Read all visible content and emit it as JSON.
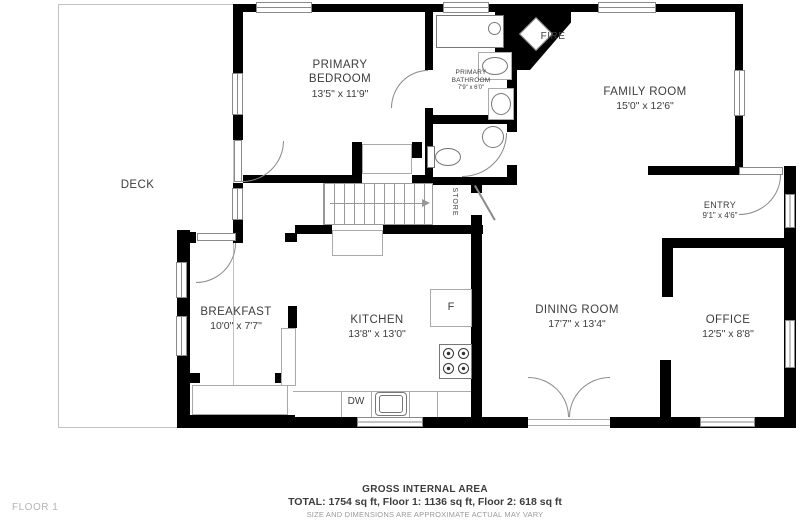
{
  "floor_label": "FLOOR 1",
  "rooms": {
    "deck": {
      "name": "DECK"
    },
    "primary_bedroom": {
      "name": "PRIMARY BEDROOM",
      "dims": "13'5\" x 11'9\""
    },
    "primary_bathroom": {
      "name": "PRIMARY BATHROOM",
      "dims": "7'9\" x 6'0\""
    },
    "family_room": {
      "name": "FAMILY ROOM",
      "dims": "15'0\" x 12'6\""
    },
    "entry": {
      "name": "ENTRY",
      "dims": "9'1\" x 4'6\""
    },
    "breakfast": {
      "name": "BREAKFAST",
      "dims": "10'0\" x 7'7\""
    },
    "kitchen": {
      "name": "KITCHEN",
      "dims": "13'8\" x 13'0\""
    },
    "dining_room": {
      "name": "DINING ROOM",
      "dims": "17'7\" x 13'4\""
    },
    "office": {
      "name": "OFFICE",
      "dims": "12'5\" x 8'8\""
    }
  },
  "labels": {
    "fireplace": "FIRE",
    "store": "STORE",
    "fridge": "F",
    "dishwasher": "DW"
  },
  "footer": {
    "title": "GROSS INTERNAL AREA",
    "totals": "TOTAL: 1754 sq ft, Floor 1: 1136 sq ft, Floor 2: 618 sq ft",
    "disclaimer": "SIZE AND DIMENSIONS ARE APPROXIMATE ACTUAL MAY VARY"
  }
}
